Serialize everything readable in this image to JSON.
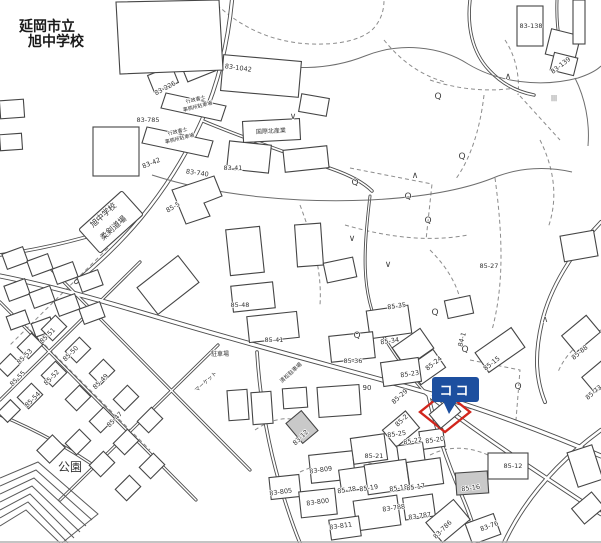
{
  "place_labels": {
    "marker": "ココ",
    "park": "公園",
    "school_line1": "延岡市立",
    "school_line2": "旭中学校",
    "dojo_line1": "旭中学校",
    "dojo_line2": "柔剣道場"
  },
  "colors": {
    "marker_blue": "#1d4f9f",
    "marker_blue_dark": "#123c7d",
    "target_red": "#d2251c",
    "line_gray": "#4d4d4d",
    "label_gray": "#333333",
    "white": "#ffffff"
  },
  "map_labels": [
    {
      "t": "延岡市立",
      "x": 47,
      "y": 31,
      "r": 0,
      "s": 14,
      "b": true
    },
    {
      "t": "旭中学校",
      "x": 56,
      "y": 46,
      "r": 0,
      "s": 14,
      "b": true
    },
    {
      "t": "旭中学校",
      "x": 105,
      "y": 217,
      "r": -42,
      "s": 8
    },
    {
      "t": "柔剣道場",
      "x": 115,
      "y": 230,
      "r": -42,
      "s": 8
    },
    {
      "t": "公園",
      "x": 70,
      "y": 471,
      "r": 0,
      "s": 12
    },
    {
      "t": "83-138",
      "x": 531,
      "y": 28,
      "r": 0,
      "s": 6.5
    },
    {
      "t": "83-139",
      "x": 562,
      "y": 67,
      "r": -38,
      "s": 6.5
    },
    {
      "t": "83-1042",
      "x": 238,
      "y": 70,
      "r": 8,
      "s": 6.5
    },
    {
      "t": "83-226",
      "x": 166,
      "y": 90,
      "r": -28,
      "s": 6.5
    },
    {
      "t": "83-785",
      "x": 148,
      "y": 122,
      "r": 0,
      "s": 6.5
    },
    {
      "t": "83-42",
      "x": 152,
      "y": 165,
      "r": -22,
      "s": 6.5
    },
    {
      "t": "83-740",
      "x": 197,
      "y": 175,
      "r": 8,
      "s": 6.5
    },
    {
      "t": "83-41",
      "x": 233,
      "y": 170,
      "r": 0,
      "s": 6.5
    },
    {
      "t": "85-5",
      "x": 174,
      "y": 209,
      "r": -30,
      "s": 6.5
    },
    {
      "t": "行政書士",
      "x": 196,
      "y": 101,
      "r": -14,
      "s": 5
    },
    {
      "t": "事務所駐車場",
      "x": 198,
      "y": 108,
      "r": -14,
      "s": 5
    },
    {
      "t": "行政書士",
      "x": 178,
      "y": 133,
      "r": -14,
      "s": 5
    },
    {
      "t": "事務所駐車場",
      "x": 180,
      "y": 140,
      "r": -14,
      "s": 5
    },
    {
      "t": "国際北産業",
      "x": 271,
      "y": 133,
      "r": -3,
      "s": 6
    },
    {
      "t": "85-48",
      "x": 240,
      "y": 307,
      "r": 0,
      "s": 6.5
    },
    {
      "t": "85-41",
      "x": 274,
      "y": 342,
      "r": 0,
      "s": 6.5
    },
    {
      "t": "駐車場",
      "x": 220,
      "y": 356,
      "r": 0,
      "s": 6
    },
    {
      "t": "清松駐車場",
      "x": 292,
      "y": 374,
      "r": -42,
      "s": 5.5
    },
    {
      "t": "マーケット",
      "x": 207,
      "y": 383,
      "r": -42,
      "s": 5.5
    },
    {
      "t": "85-35",
      "x": 397,
      "y": 308,
      "r": -8,
      "s": 6.5
    },
    {
      "t": "85-34",
      "x": 390,
      "y": 343,
      "r": -8,
      "s": 6.5
    },
    {
      "t": "85-36",
      "x": 353,
      "y": 363,
      "r": 0,
      "s": 6.5
    },
    {
      "t": "85-23",
      "x": 410,
      "y": 376,
      "r": -8,
      "s": 6.5
    },
    {
      "t": "85-24",
      "x": 435,
      "y": 365,
      "r": -38,
      "s": 6.5
    },
    {
      "t": "84-1",
      "x": 464,
      "y": 340,
      "r": -75,
      "s": 6.5
    },
    {
      "t": "85-27",
      "x": 489,
      "y": 268,
      "r": 0,
      "s": 6.5
    },
    {
      "t": "85-15",
      "x": 493,
      "y": 365,
      "r": -38,
      "s": 6.5
    },
    {
      "t": "90",
      "x": 367,
      "y": 390,
      "r": 0,
      "s": 7
    },
    {
      "t": "85-29",
      "x": 401,
      "y": 398,
      "r": -42,
      "s": 6.5
    },
    {
      "t": "85-2",
      "x": 403,
      "y": 422,
      "r": -42,
      "s": 6.5
    },
    {
      "t": "85-88",
      "x": 581,
      "y": 354,
      "r": -40,
      "s": 6.5
    },
    {
      "t": "85-73",
      "x": 595,
      "y": 394,
      "r": -40,
      "s": 6.5
    },
    {
      "t": "85-51",
      "x": 49,
      "y": 337,
      "r": -45,
      "s": 6.5
    },
    {
      "t": "85-50",
      "x": 72,
      "y": 355,
      "r": -45,
      "s": 6.5
    },
    {
      "t": "85-53",
      "x": 26,
      "y": 358,
      "r": -45,
      "s": 6.5
    },
    {
      "t": "85-52",
      "x": 53,
      "y": 379,
      "r": -45,
      "s": 6.5
    },
    {
      "t": "85-55",
      "x": 19,
      "y": 380,
      "r": -45,
      "s": 6.5
    },
    {
      "t": "85-54",
      "x": 34,
      "y": 401,
      "r": -45,
      "s": 6.5
    },
    {
      "t": "85-49",
      "x": 102,
      "y": 383,
      "r": -45,
      "s": 6.5
    },
    {
      "t": "85-47",
      "x": 116,
      "y": 421,
      "r": -45,
      "s": 6.5
    },
    {
      "t": "83-12",
      "x": 302,
      "y": 439,
      "r": -45,
      "s": 6.5
    },
    {
      "t": "85-21",
      "x": 374,
      "y": 458,
      "r": 0,
      "s": 6.5
    },
    {
      "t": "85-25",
      "x": 397,
      "y": 436,
      "r": -8,
      "s": 6.5
    },
    {
      "t": "85-22",
      "x": 413,
      "y": 443,
      "r": -8,
      "s": 6.5
    },
    {
      "t": "85-20",
      "x": 435,
      "y": 442,
      "r": -8,
      "s": 6.5
    },
    {
      "t": "83-809",
      "x": 321,
      "y": 472,
      "r": -8,
      "s": 6.5
    },
    {
      "t": "83-805",
      "x": 281,
      "y": 494,
      "r": -8,
      "s": 6.5
    },
    {
      "t": "83-800",
      "x": 318,
      "y": 504,
      "r": -8,
      "s": 6.5
    },
    {
      "t": "85-78",
      "x": 347,
      "y": 492,
      "r": -8,
      "s": 6.5
    },
    {
      "t": "85-19",
      "x": 369,
      "y": 490,
      "r": -8,
      "s": 6.5
    },
    {
      "t": "85-18",
      "x": 399,
      "y": 490,
      "r": -8,
      "s": 6.5
    },
    {
      "t": "85-17",
      "x": 416,
      "y": 489,
      "r": -8,
      "s": 6.5
    },
    {
      "t": "85-16",
      "x": 471,
      "y": 490,
      "r": -8,
      "s": 6.5
    },
    {
      "t": "85-12",
      "x": 513,
      "y": 468,
      "r": 0,
      "s": 6.5
    },
    {
      "t": "83-788",
      "x": 394,
      "y": 510,
      "r": -8,
      "s": 6.5
    },
    {
      "t": "83-787",
      "x": 420,
      "y": 518,
      "r": -8,
      "s": 6.5
    },
    {
      "t": "83-811",
      "x": 341,
      "y": 528,
      "r": -8,
      "s": 6.5
    },
    {
      "t": "83-786",
      "x": 444,
      "y": 531,
      "r": -45,
      "s": 6.5
    },
    {
      "t": "83-76",
      "x": 490,
      "y": 528,
      "r": -20,
      "s": 6.5
    }
  ],
  "map_symbols": [
    {
      "g": "Q",
      "x": 438,
      "y": 99
    },
    {
      "g": "Q",
      "x": 462,
      "y": 159
    },
    {
      "g": "Q",
      "x": 355,
      "y": 185
    },
    {
      "g": "Q",
      "x": 408,
      "y": 199
    },
    {
      "g": "Q",
      "x": 428,
      "y": 223
    },
    {
      "g": "Q",
      "x": 435,
      "y": 315
    },
    {
      "g": "Q",
      "x": 357,
      "y": 338
    },
    {
      "g": "Q",
      "x": 465,
      "y": 352
    },
    {
      "g": "Q",
      "x": 518,
      "y": 389
    },
    {
      "g": "∧",
      "x": 508,
      "y": 79
    },
    {
      "g": "∧",
      "x": 415,
      "y": 178
    },
    {
      "g": "∧",
      "x": 545,
      "y": 322
    },
    {
      "g": "∨",
      "x": 293,
      "y": 119
    },
    {
      "g": "∨",
      "x": 352,
      "y": 241
    },
    {
      "g": "∨",
      "x": 388,
      "y": 267
    },
    {
      "g": "|||",
      "x": 554,
      "y": 100,
      "s": 6
    }
  ]
}
